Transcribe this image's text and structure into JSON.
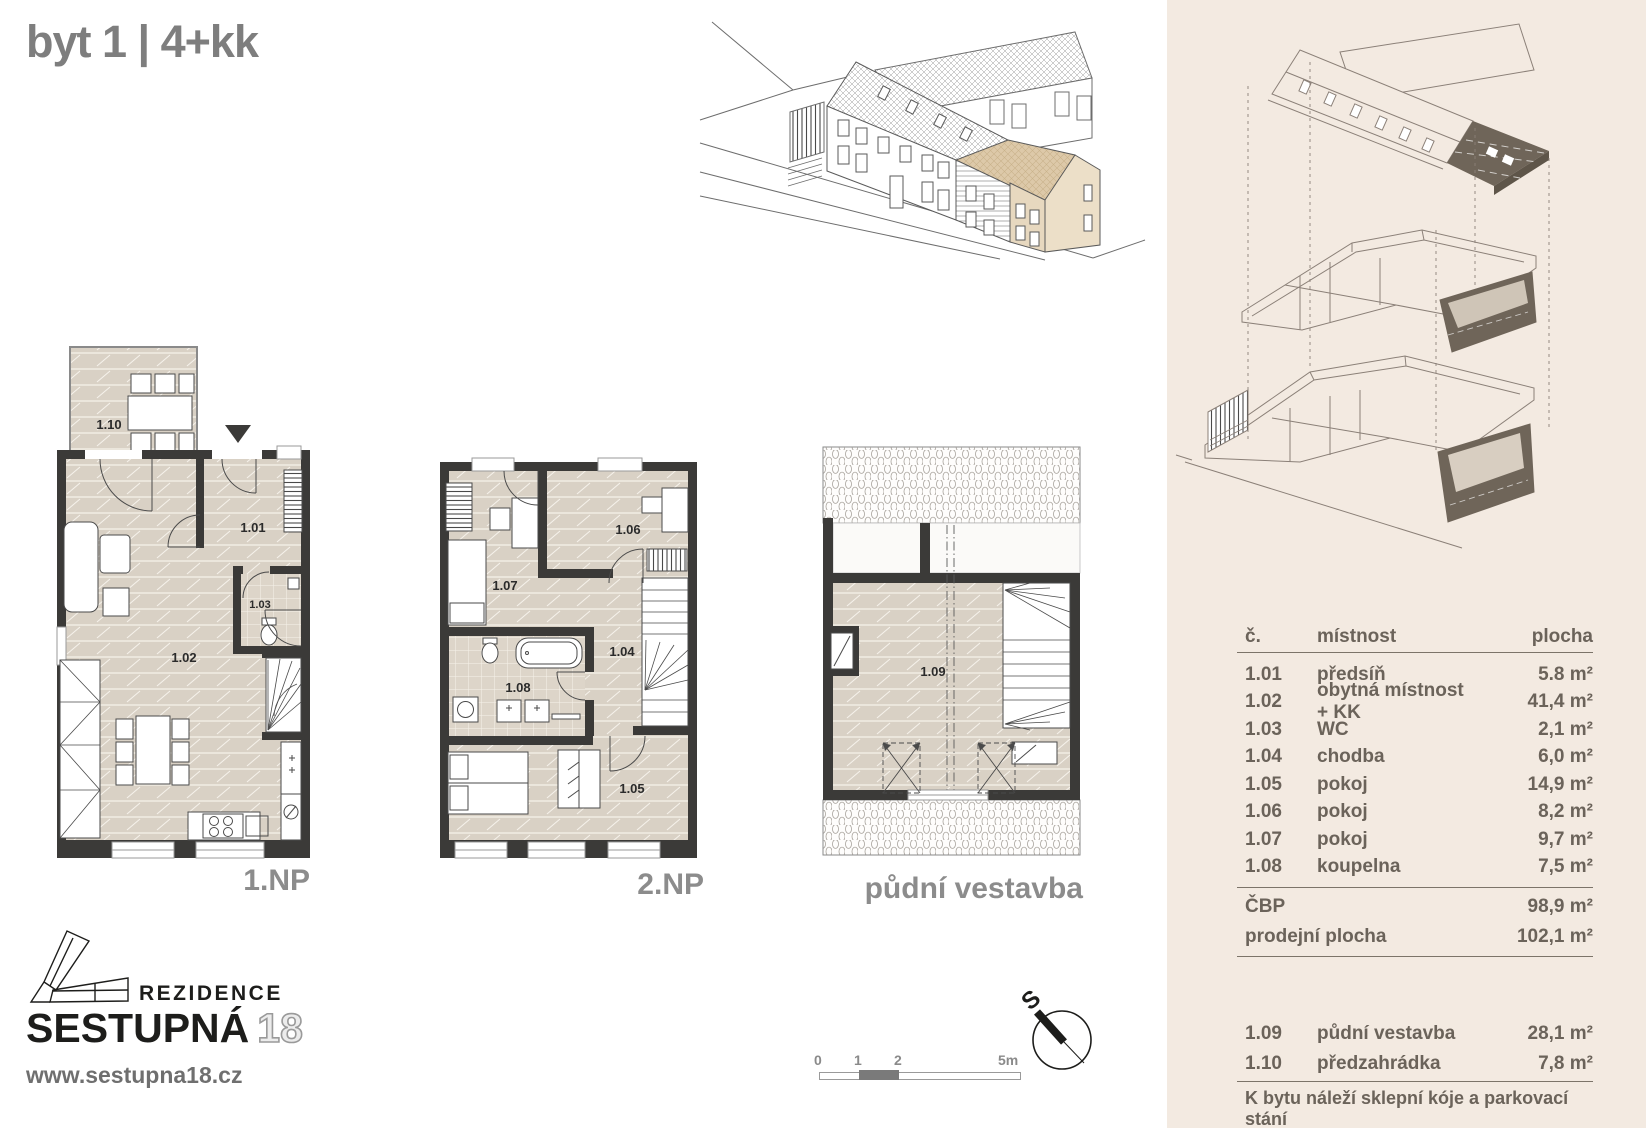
{
  "title": "byt 1 | 4+kk",
  "panel": {
    "table": {
      "headers": {
        "num": "č.",
        "room": "místnost",
        "area": "plocha"
      },
      "rows": [
        {
          "num": "1.01",
          "room": "předsíň",
          "area": "5.8 m²"
        },
        {
          "num": "1.02",
          "room": "obytná místnost + KK",
          "area": "41,4 m²"
        },
        {
          "num": "1.03",
          "room": "WC",
          "area": "2,1 m²"
        },
        {
          "num": "1.04",
          "room": "chodba",
          "area": "6,0 m²"
        },
        {
          "num": "1.05",
          "room": "pokoj",
          "area": "14,9 m²"
        },
        {
          "num": "1.06",
          "room": "pokoj",
          "area": "8,2 m²"
        },
        {
          "num": "1.07",
          "room": "pokoj",
          "area": "9,7 m²"
        },
        {
          "num": "1.08",
          "room": "koupelna",
          "area": "7,5 m²"
        }
      ],
      "summary": [
        {
          "label": "ČBP",
          "area": "98,9 m²"
        },
        {
          "label": "prodejní plocha",
          "area": "102,1 m²"
        }
      ],
      "extra": [
        {
          "num": "1.09",
          "room": "půdní vestavba",
          "area": "28,1 m²"
        },
        {
          "num": "1.10",
          "room": "předzahrádka",
          "area": "7,8 m²"
        }
      ],
      "footnote": "K bytu náleží sklepní kóje a parkovací stání"
    }
  },
  "plans": {
    "np1": {
      "label": "1.NP",
      "r101": "1.01",
      "r102": "1.02",
      "r103": "1.03",
      "r110": "1.10"
    },
    "np2": {
      "label": "2.NP",
      "r104": "1.04",
      "r105": "1.05",
      "r106": "1.06",
      "r107": "1.07",
      "r108": "1.08"
    },
    "attic": {
      "label": "půdní vestavba",
      "r109": "1.09"
    }
  },
  "scale_bar": {
    "t0": "0",
    "t1": "1",
    "t2": "2",
    "t5": "5m"
  },
  "compass": {
    "north": "S"
  },
  "brand": {
    "prefix": "REZIDENCE",
    "name": "SESTUPNÁ",
    "number": "18",
    "url": "www.sestupna18.cz"
  },
  "colors": {
    "panel_bg": "#f3eae1",
    "floor": "#d9d1c5",
    "wall": "#3b3a38",
    "beige_unit": "#ddc9a9",
    "axon_line": "#8b8078",
    "axon_dark": "#6f6559",
    "title_gray": "#7e7e7e",
    "table_text": "#6b635a"
  }
}
